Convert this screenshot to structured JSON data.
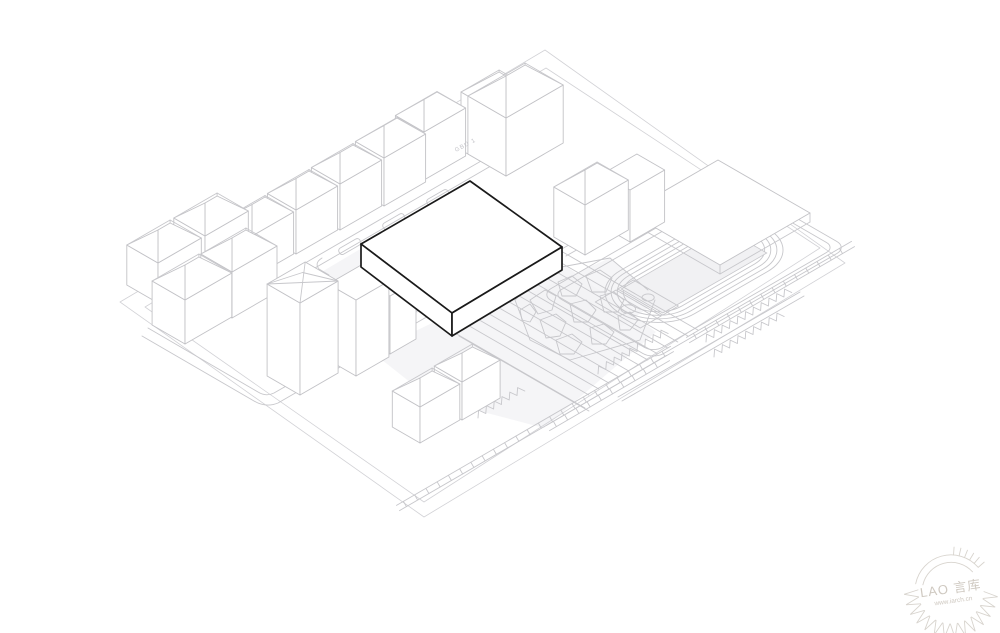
{
  "page": {
    "background": "#ffffff"
  },
  "colors": {
    "context_line": "#c7c7cb",
    "boundary_line": "#d2d2d6",
    "hero_outline": "#1a1a1a",
    "hero_fill": "#ffffff",
    "plaza_fill": "#f2f2f4",
    "field_fill": "#f1f1f3",
    "watermark": "#d8d4ce"
  },
  "labels": {
    "road_label": "GBU 1"
  },
  "watermark": {
    "line1": "LAO 言库",
    "line2": "www.iarch.cn"
  },
  "diagram": {
    "houses": [
      {
        "f": [
          252,
          278
        ],
        "l": 48,
        "d": 33,
        "h": 42,
        "r": 15,
        "dir": "ne"
      },
      {
        "f": [
          296,
          254
        ],
        "l": 48,
        "d": 33,
        "h": 44,
        "r": 15,
        "dir": "ne"
      },
      {
        "f": [
          340,
          230
        ],
        "l": 48,
        "d": 33,
        "h": 46,
        "r": 15,
        "dir": "ne"
      },
      {
        "f": [
          384,
          206
        ],
        "l": 48,
        "d": 33,
        "h": 48,
        "r": 16,
        "dir": "ne"
      },
      {
        "f": [
          424,
          180
        ],
        "l": 48,
        "d": 33,
        "h": 48,
        "r": 16,
        "dir": "ne"
      },
      {
        "f": [
          506,
          176
        ],
        "l": 52,
        "d": 44,
        "h": 58,
        "r": 20,
        "dir": "nw"
      },
      {
        "f": [
          506,
          176
        ],
        "l": 66,
        "d": 44,
        "h": 58,
        "r": 20,
        "dir": "ne"
      },
      {
        "f": [
          185,
          344
        ],
        "l": 54,
        "d": 38,
        "h": 44,
        "r": 16,
        "dir": "ne"
      },
      {
        "f": [
          232,
          318
        ],
        "l": 52,
        "d": 36,
        "h": 46,
        "r": 16,
        "dir": "ne"
      },
      {
        "f": [
          158,
          303
        ],
        "l": 50,
        "d": 36,
        "h": 40,
        "r": 15,
        "dir": "ne"
      },
      {
        "f": [
          205,
          278
        ],
        "l": 50,
        "d": 36,
        "h": 42,
        "r": 15,
        "dir": "ne"
      },
      {
        "f": [
          420,
          443
        ],
        "l": 46,
        "d": 32,
        "h": 36,
        "r": 13,
        "dir": "ne"
      },
      {
        "f": [
          462,
          420
        ],
        "l": 44,
        "d": 32,
        "h": 38,
        "r": 13,
        "dir": "ne"
      },
      {
        "f": [
          585,
          255
        ],
        "l": 50,
        "d": 36,
        "h": 50,
        "r": 17,
        "dir": "ne"
      },
      {
        "f": [
          630,
          242
        ],
        "l": 40,
        "d": 32,
        "h": 52,
        "r": 0,
        "dir": "ne"
      },
      {
        "f": [
          300,
          395
        ],
        "l": 44,
        "d": 38,
        "h": 92,
        "r": 0,
        "dir": "ne",
        "xtop": true
      },
      {
        "f": [
          356,
          376
        ],
        "l": 38,
        "d": 32,
        "h": 76,
        "r": 0,
        "dir": "ne"
      },
      {
        "f": [
          390,
          354
        ],
        "l": 30,
        "d": 28,
        "h": 58,
        "r": 0,
        "dir": "ne"
      }
    ],
    "bands": [
      {
        "a": [
          398,
          508
        ],
        "b": [
          672,
          349
        ]
      },
      {
        "a": [
          688,
          340
        ],
        "b": [
          853,
          244
        ]
      },
      {
        "a": [
          548,
          428
        ],
        "b": [
          668,
          358
        ]
      }
    ],
    "zigzags": [
      {
        "p": [
          598,
          374
        ],
        "n": 9
      },
      {
        "p": [
          706,
          342
        ],
        "n": 11
      },
      {
        "p": [
          714,
          357
        ],
        "n": 9
      },
      {
        "p": [
          448,
          412
        ],
        "n": 6
      },
      {
        "p": [
          478,
          418
        ],
        "n": 6
      }
    ],
    "paving": [
      {
        "s": [
          452,
          316
        ],
        "len": 158
      },
      {
        "s": [
          462,
          310
        ],
        "len": 158
      },
      {
        "s": [
          472,
          304
        ],
        "len": 158
      },
      {
        "s": [
          482,
          298
        ],
        "len": 158
      },
      {
        "s": [
          492,
          292
        ],
        "len": 158
      },
      {
        "s": [
          502,
          286
        ],
        "len": 158
      },
      {
        "s": [
          511,
          281
        ],
        "len": 158
      },
      {
        "s": [
          521,
          275
        ],
        "len": 158
      },
      {
        "s": [
          531,
          269
        ],
        "len": 158
      },
      {
        "s": [
          541,
          263
        ],
        "len": 158
      },
      {
        "s": [
          551,
          257
        ],
        "len": 158
      },
      {
        "s": [
          561,
          251
        ],
        "len": 158
      },
      {
        "s": [
          455,
          333
        ],
        "len": 150
      },
      {
        "s": [
          459,
          336
        ],
        "len": 150
      },
      {
        "s": [
          320,
          302
        ],
        "len": 60
      },
      {
        "s": [
          334,
          310
        ],
        "len": 60
      }
    ]
  }
}
